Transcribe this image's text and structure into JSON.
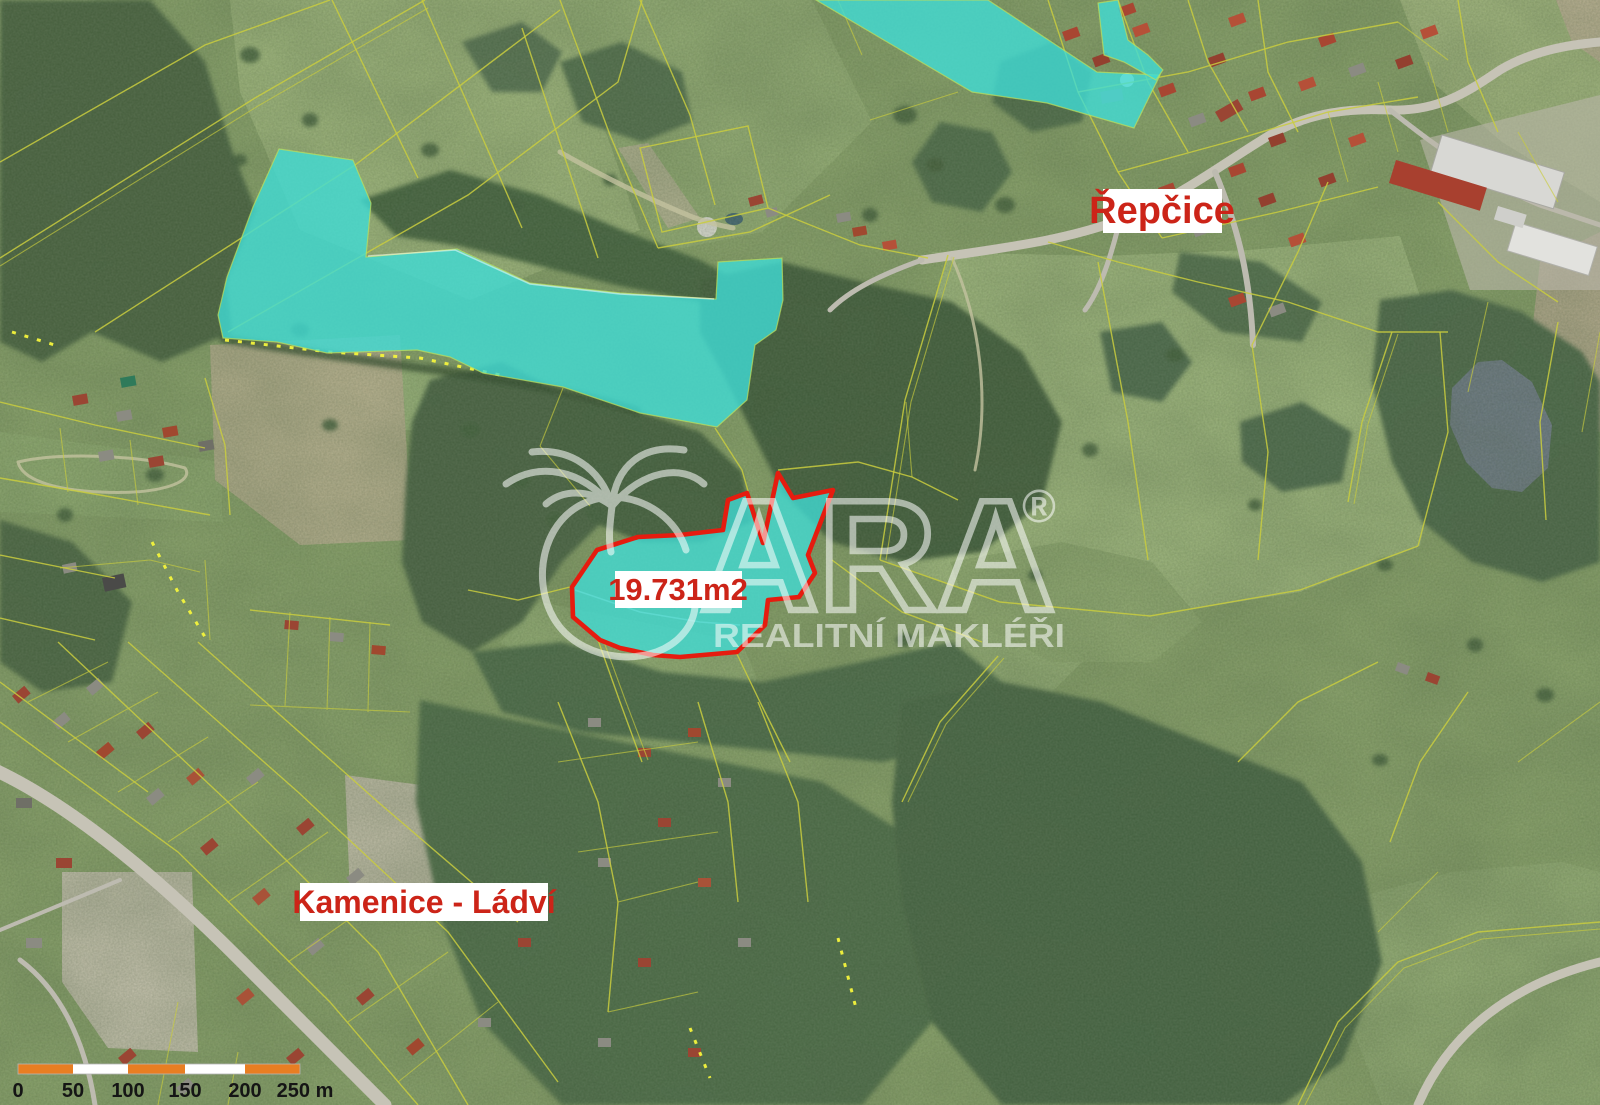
{
  "map_labels": {
    "settlement_top_right": "Řepčice",
    "settlement_bottom_left": "Kamenice - Ládví",
    "selected_parcel_area": "19.731m2"
  },
  "watermark": {
    "letters": "ARA",
    "registered": "®",
    "subtitle": "REALITNÍ MAKLÉŘI"
  },
  "scale_bar": {
    "ticks": [
      "0",
      "50",
      "100",
      "150",
      "200",
      "250 m"
    ]
  },
  "colors": {
    "highlight_fill": "#40dcd6",
    "selected_outline": "#e51c0f",
    "label_text": "#cc2418",
    "cadastral_line": "#c9cd3e",
    "scalebar_orange": "#e87e22"
  }
}
